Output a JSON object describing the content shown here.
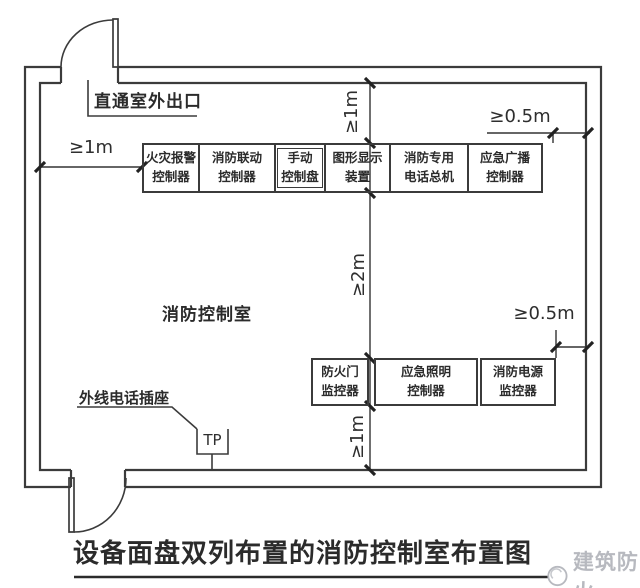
{
  "diagram": {
    "title": "设备面盘双列布置的消防控制室布置图",
    "room_label": "消防控制室",
    "exit_label": "直通室外出口",
    "phone": {
      "label": "外线电话插座",
      "symbol": "TP"
    },
    "dimensions": {
      "left": "≥1m",
      "top": "≥1m",
      "top_right": "≥0.5m",
      "middle": "≥2m",
      "bottom_right": "≥0.5m",
      "bottom": "≥1m"
    },
    "top_row": [
      {
        "line1": "火灾报警",
        "line2": "控制器"
      },
      {
        "line1": "消防联动",
        "line2": "控制器"
      },
      {
        "line1": "手动",
        "line2": "控制盘"
      },
      {
        "line1": "图形显示",
        "line2": "装置"
      },
      {
        "line1": "消防专用",
        "line2": "电话总机"
      },
      {
        "line1": "应急广播",
        "line2": "控制器"
      }
    ],
    "bottom_row": [
      {
        "line1": "防火门",
        "line2": "监控器"
      },
      {
        "line1": "应急照明",
        "line2": "控制器"
      },
      {
        "line1": "消防电源",
        "line2": "监控器"
      }
    ],
    "watermark": {
      "text": "建筑防火",
      "icon": "swirl-circle-icon",
      "color": "#b7b9bf"
    },
    "colors": {
      "line": "#3b3b3b",
      "text": "#2b2b2b"
    }
  }
}
